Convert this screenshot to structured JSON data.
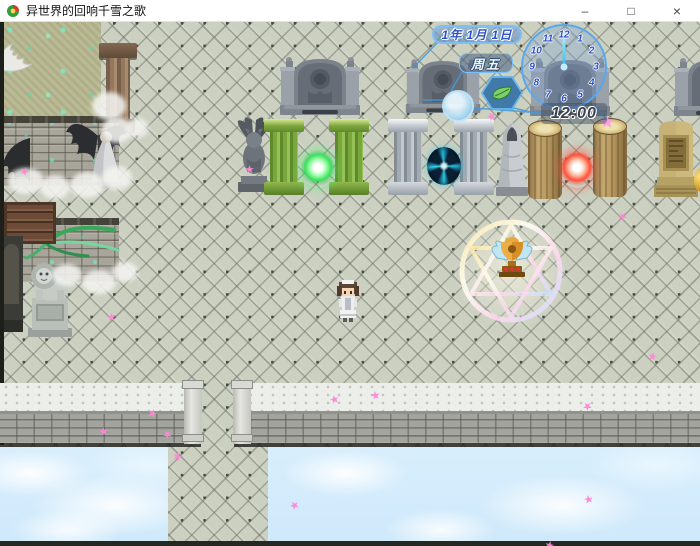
{
  "window": {
    "title": "异世界的回响千雪之歌",
    "controls": {
      "minimize": "–",
      "maximize": "□",
      "close": "×"
    }
  },
  "hud": {
    "date": "1年 1月 1日",
    "weekday": "周五",
    "time": "12:00",
    "clock_numbers": [
      "12",
      "1",
      "2",
      "3",
      "4",
      "5",
      "6",
      "7",
      "8",
      "9",
      "10",
      "11"
    ],
    "colors": {
      "accent": "#3f9be0",
      "date_text": "#2b50c8",
      "weekday_text": "#f4f8fb",
      "time_text": "#3b4250",
      "clock_hand": "#28c0ee"
    }
  },
  "scene": {
    "objects": [
      "tomb-monument",
      "gargoyle-statue",
      "moss-pillar",
      "green-orb",
      "stone-pillar",
      "portal-vortex",
      "cloaked-statue",
      "wood-log-pillar",
      "red-orb",
      "gold-monument",
      "angel-statue",
      "lion-statue",
      "magic-circle",
      "trophy-emblem",
      "player-character",
      "parapet-ledge",
      "sky-clouds"
    ],
    "colors": {
      "floor": "#cbd0c1",
      "sky": "#cfe9fb",
      "green_orb": "#3ae05e",
      "red_orb": "#ff5038",
      "vortex": "#2dd0f2",
      "petal": "#ff86d6"
    }
  },
  "decor": {
    "petals": [
      [
        245,
        143
      ],
      [
        487,
        90
      ],
      [
        20,
        145
      ],
      [
        107,
        291
      ],
      [
        290,
        479
      ],
      [
        148,
        387
      ],
      [
        99,
        405
      ],
      [
        163,
        408
      ],
      [
        173,
        430
      ],
      [
        371,
        369
      ],
      [
        583,
        380
      ],
      [
        545,
        519
      ],
      [
        584,
        473
      ],
      [
        618,
        190
      ],
      [
        648,
        330
      ],
      [
        330,
        373
      ]
    ]
  }
}
